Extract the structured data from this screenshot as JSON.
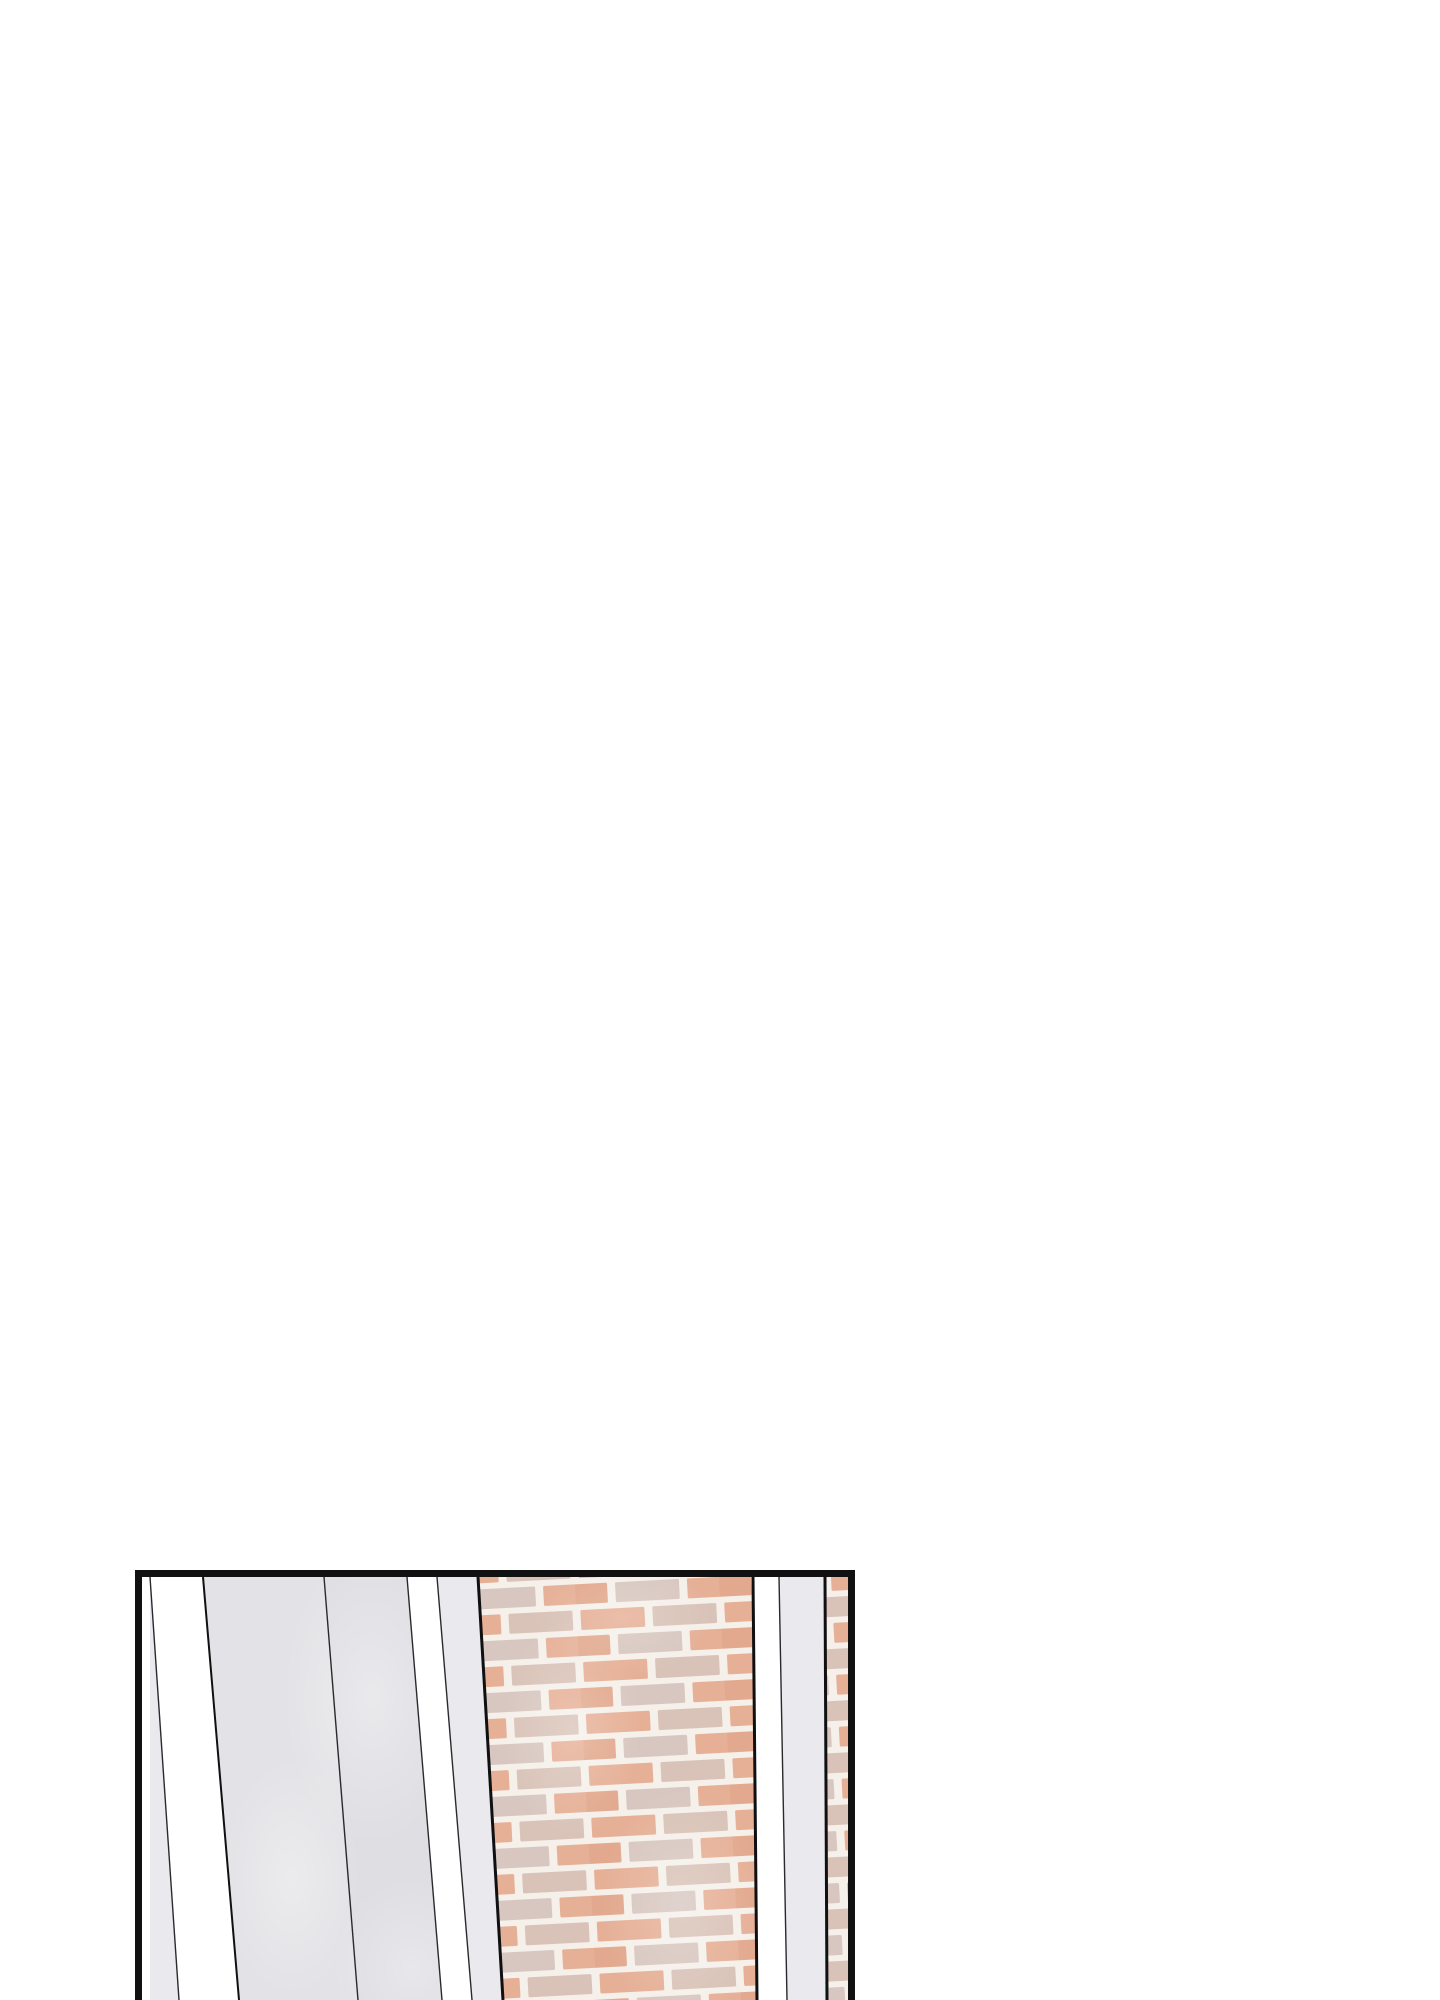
{
  "page": {
    "width": 1440,
    "height": 2000,
    "background": "#ffffff",
    "description": "Webtoon comic page, blank white except one panel at the bottom edge, cut off by the page bottom."
  },
  "panel": {
    "x": 135,
    "y": 1570,
    "width": 720,
    "height": 430,
    "border_px": 7,
    "border_color": "#111111",
    "scene": "Tilted perspective view of building exterior: white gaps, light-gray concrete pillar faces, and a salmon brick wall; second narrow brick strip at right edge."
  },
  "colors": {
    "white": "#ffffff",
    "light_gray": "#eaeaee",
    "concrete_1": "#e3e3e7",
    "concrete_2": "#dedee3",
    "line_thin": "#2a2a2e",
    "line_thick": "#101012",
    "mortar": "#f5f0ea",
    "texture_wash": "#ffffff"
  },
  "geometry": {
    "boundaries": [
      {
        "name": "frame-left-inner",
        "top": 8,
        "bottom": 8,
        "stroke": 0
      },
      {
        "name": "edge-line-1",
        "top": 8,
        "bottom": 37,
        "stroke": 1.4,
        "tone": "thin"
      },
      {
        "name": "edge-line-2",
        "top": 61,
        "bottom": 97,
        "stroke": 2,
        "tone": "thick"
      },
      {
        "name": "concrete-split-line",
        "top": 182,
        "bottom": 216,
        "stroke": 1.4,
        "tone": "thin"
      },
      {
        "name": "edge-line-3",
        "top": 265,
        "bottom": 300,
        "stroke": 1.4,
        "tone": "thin"
      },
      {
        "name": "edge-line-4",
        "top": 295,
        "bottom": 330,
        "stroke": 1.4,
        "tone": "thin"
      },
      {
        "name": "brick-left-edge",
        "top": 336,
        "bottom": 361,
        "stroke": 3,
        "tone": "thick"
      },
      {
        "name": "brick-right-edge",
        "top": 611,
        "bottom": 615,
        "stroke": 3,
        "tone": "thick"
      },
      {
        "name": "edge-line-5",
        "top": 637,
        "bottom": 645,
        "stroke": 1.4,
        "tone": "thin"
      },
      {
        "name": "right-brick-left-edge",
        "top": 683,
        "bottom": 685,
        "stroke": 3,
        "tone": "thick"
      },
      {
        "name": "frame-right-inner",
        "top": 713,
        "bottom": 713,
        "stroke": 0
      }
    ],
    "stripes": [
      {
        "name": "pillar-sliver-left",
        "fill": "light_gray"
      },
      {
        "name": "white-gap-1",
        "fill": "white"
      },
      {
        "name": "concrete-face-1",
        "fill": "concrete_1"
      },
      {
        "name": "concrete-face-2",
        "fill": "concrete_2"
      },
      {
        "name": "white-gap-2",
        "fill": "white"
      },
      {
        "name": "pillar-face-mid",
        "fill": "light_gray"
      },
      {
        "name": "brick-wall-main",
        "fill": "brick"
      },
      {
        "name": "white-gap-3",
        "fill": "white"
      },
      {
        "name": "pillar-face-right",
        "fill": "light_gray"
      },
      {
        "name": "brick-strip-right",
        "fill": "brick"
      }
    ]
  },
  "brick": {
    "tile_w": 144,
    "tile_h": 52,
    "brick_w": 64,
    "brick_h": 20,
    "row1_y": 4,
    "row2_y": 30,
    "row2_offset": -32,
    "corner_radius": 1.5,
    "rotation_deg": -3,
    "mortar": "#f5f0ea",
    "tones": [
      "#e6b097",
      "#d9c3b8",
      "#e2a98e",
      "#d8c7c0"
    ]
  },
  "texture": [
    {
      "target": "concrete",
      "cx": 230,
      "cy": 120,
      "rx": 90,
      "ry": 150,
      "opacity": 0.35
    },
    {
      "target": "concrete",
      "cx": 150,
      "cy": 300,
      "rx": 70,
      "ry": 120,
      "opacity": 0.3
    },
    {
      "target": "concrete",
      "cx": 270,
      "cy": 390,
      "rx": 80,
      "ry": 90,
      "opacity": 0.3
    },
    {
      "target": "brick",
      "cx": 430,
      "cy": 150,
      "rx": 70,
      "ry": 110,
      "opacity": 0.22
    },
    {
      "target": "brick",
      "cx": 540,
      "cy": 330,
      "rx": 80,
      "ry": 120,
      "opacity": 0.2
    },
    {
      "target": "brick",
      "cx": 480,
      "cy": 40,
      "rx": 90,
      "ry": 60,
      "opacity": 0.18
    }
  ]
}
